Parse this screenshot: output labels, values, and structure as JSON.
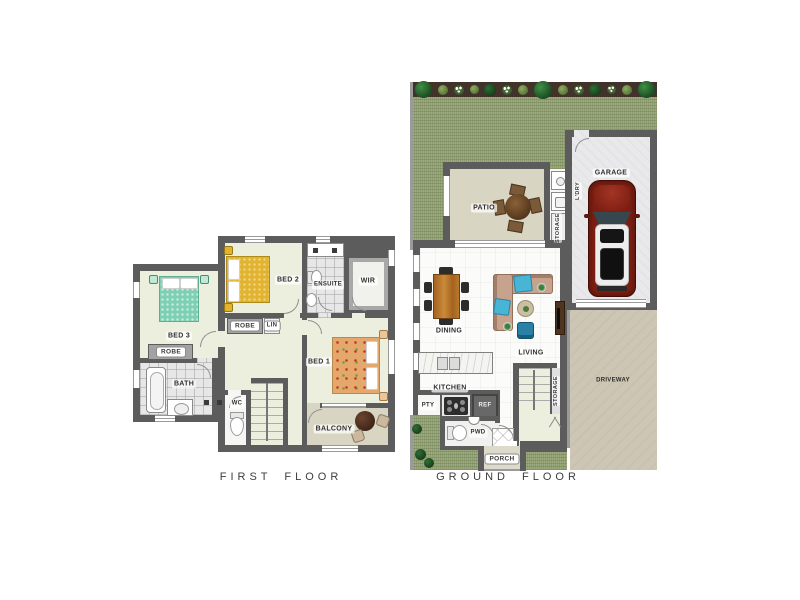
{
  "titles": {
    "first": "FIRST FLOOR",
    "ground": "GROUND FLOOR"
  },
  "first_floor": {
    "bed2": "BED 2",
    "ensuite": "ENSUITE",
    "wir": "WIR",
    "bed3": "BED 3",
    "robe_bed3": "ROBE",
    "robe_hall": "ROBE",
    "lin": "LIN",
    "bed1": "BED 1",
    "bath": "BATH",
    "wc": "WC",
    "balcony": "BALCONY"
  },
  "ground_floor": {
    "patio": "PATIO",
    "ldry": "L'DRY",
    "storage_laundry": "STORAGE",
    "garage": "GARAGE",
    "dining": "DINING",
    "living": "LIVING",
    "kitchen": "KITCHEN",
    "pty": "PTY",
    "ref": "REF",
    "pwd": "PWD",
    "storage_stairs": "STORAGE",
    "porch": "PORCH",
    "driveway": "DRIVEWAY"
  },
  "colors": {
    "wall": "#5c5c5c",
    "floor": "#eceede",
    "tile": "#e7e7e7",
    "grass": "#8f9e70",
    "garden": "#42332a",
    "patio": "#d9d5c3",
    "garage": "#e9e9eb",
    "driveway": "#cdc6b4",
    "porch": "#dedacb",
    "bed_teal": "#7ed0b4",
    "bed_yellow": "#e1b32e",
    "bed_floral": "#e4a76c",
    "sofa": "#c7a28c",
    "cyan": "#48b4d6",
    "blue_chair": "#2b80a6",
    "wood": "#b0712f",
    "car_red": "#7c1e12",
    "label_text": "#2f2f2f"
  }
}
